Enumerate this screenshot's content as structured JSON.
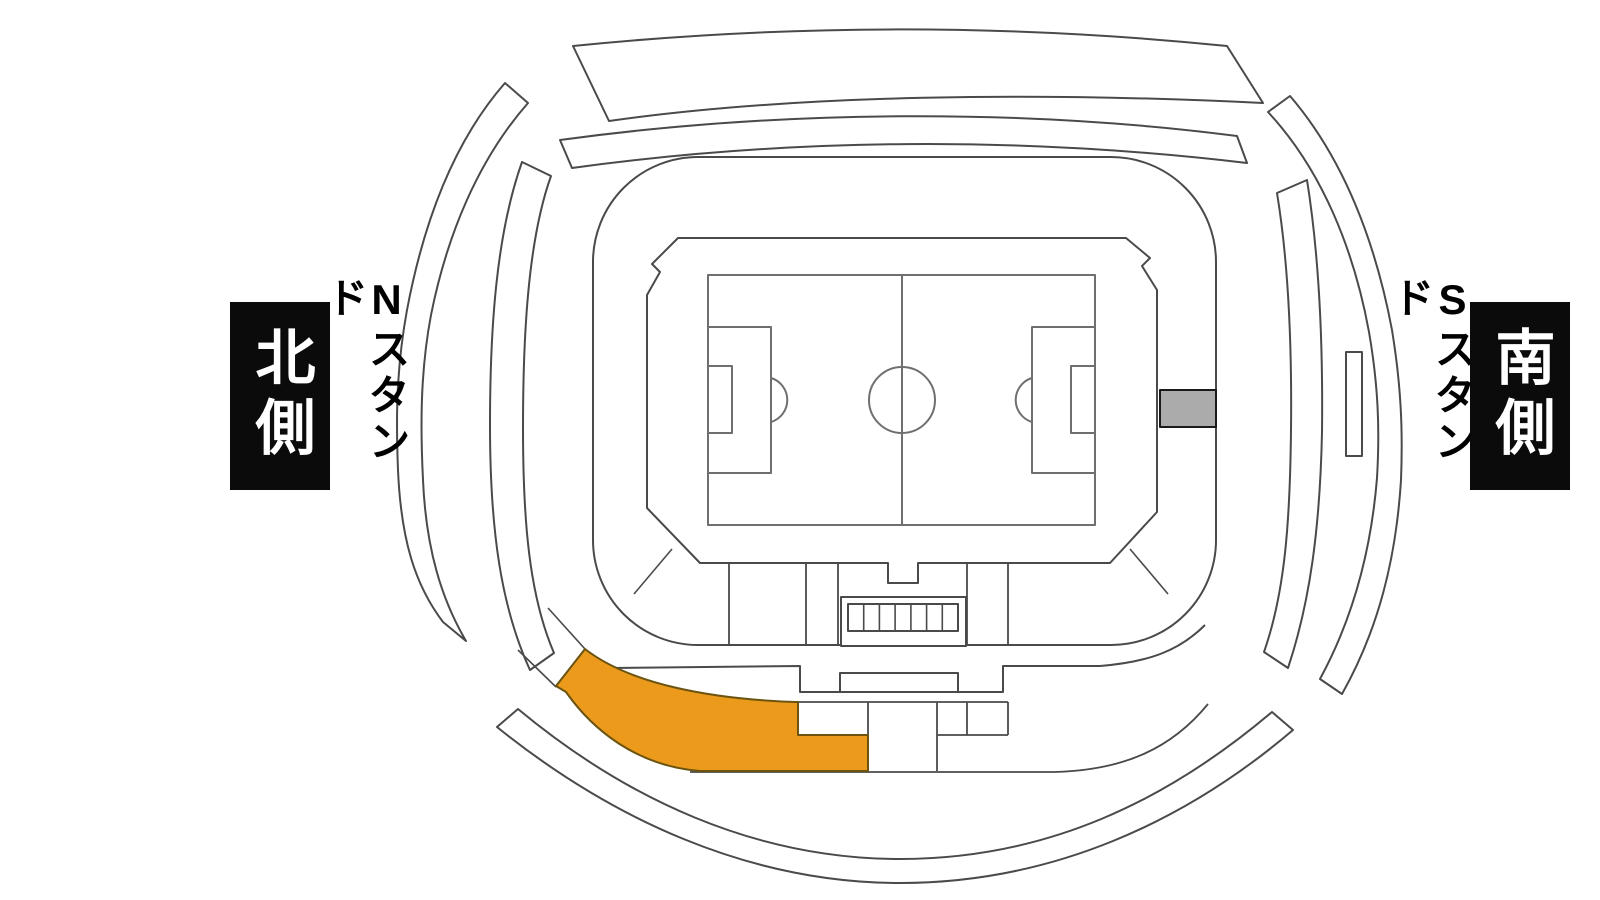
{
  "map": {
    "type": "stadium-seating-map",
    "background": "#ffffff",
    "line_color": "#4a4a4a",
    "pitch_line_color": "#6f6f6f",
    "highlight_color": "#EC9A1C",
    "highlight_stroke": "#6b5310",
    "marker_color": "#ABABAB",
    "marker_stroke": "#1a1a1a"
  },
  "labels": {
    "north": {
      "box_text": "北側",
      "stand_text": "Nスタンド",
      "box_bg": "#0b0b0b",
      "box_text_color": "#ffffff"
    },
    "south": {
      "box_text": "南側",
      "stand_text": "Sスタンド",
      "box_bg": "#0b0b0b",
      "box_text_color": "#ffffff"
    }
  }
}
